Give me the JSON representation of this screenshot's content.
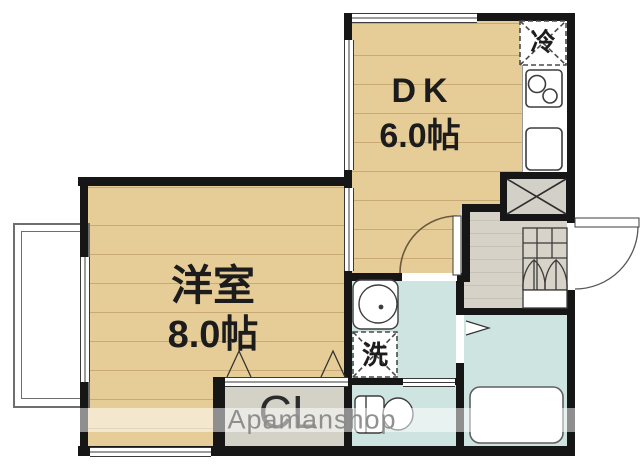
{
  "plan": {
    "type": "floor-plan",
    "watermark": "Apamanshop",
    "rooms": {
      "dk": {
        "name": "DK",
        "size": "6.0帖"
      },
      "western": {
        "name": "洋室",
        "size": "8.0帖"
      }
    },
    "labels": {
      "fridge": "冷",
      "washer": "洗",
      "closet": "CL"
    },
    "colors": {
      "wall": "#161616",
      "wood_floor": "#e6cd98",
      "wood_grain": "#c9aa72",
      "wet_area": "#cde4e1",
      "entrance_floor": "#d6d2c7",
      "watermark_text": "#8a8a8a"
    }
  }
}
